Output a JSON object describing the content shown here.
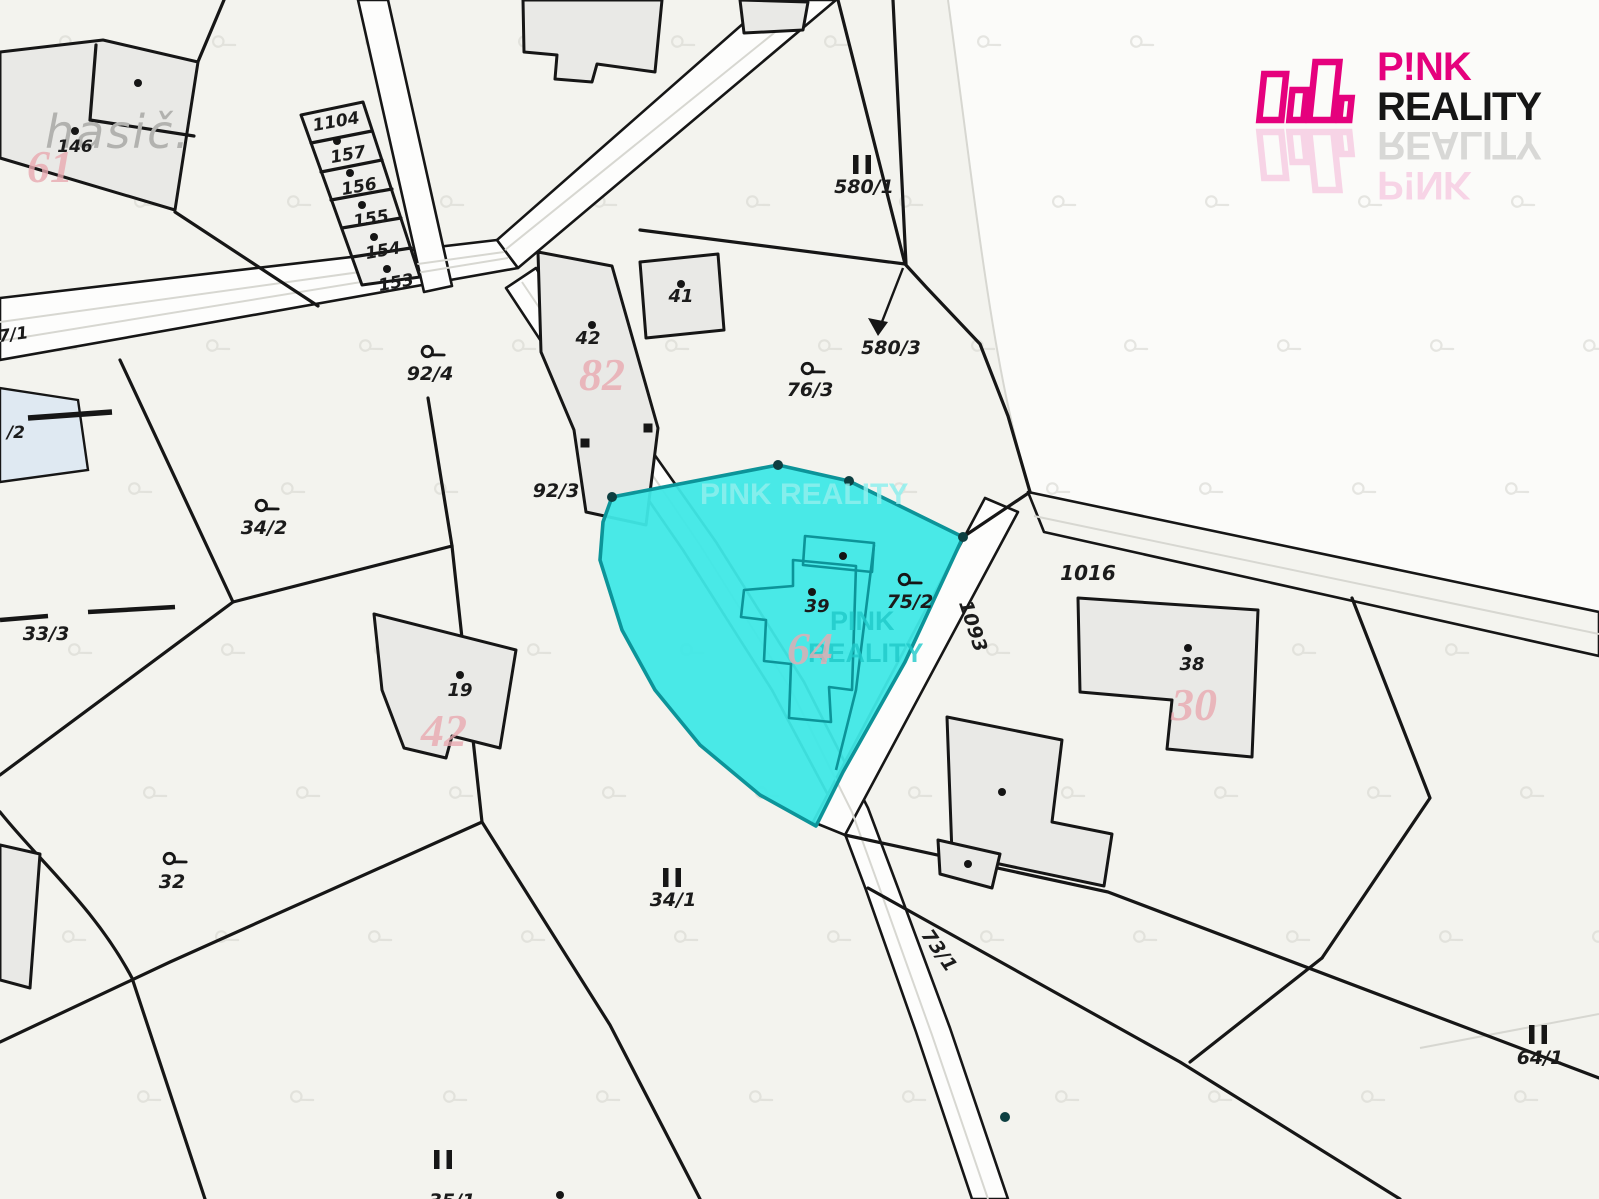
{
  "branding": {
    "pink": "P!NK",
    "reality": "REALITY",
    "magenta_color": "#e5017d",
    "text_color": "#161616"
  },
  "map": {
    "colors": {
      "background": "#f3f3ee",
      "white_region": "#fbfbf9",
      "road_fill": "#fdfdfc",
      "building_fill": "#e9e9e6",
      "boundary_line": "#161616",
      "highlight_fill": "#3fe8e6",
      "highlight_stroke": "#0c9499",
      "pink_house_number": "#e9aab1",
      "gray_area_label": "#b2b2af",
      "faint_line": "#d7d7d1",
      "water": "#dfe9f2",
      "watermark_light": "#8ff0ee",
      "watermark_dark": "#1fc9c9"
    },
    "area_label": {
      "text": "hasič.",
      "x": 118,
      "y": 148
    },
    "parcel_labels": [
      {
        "text": "146",
        "x": 75,
        "y": 152,
        "s": 17
      },
      {
        "text": "1104",
        "x": 337,
        "y": 127,
        "s": 17,
        "r": -10
      },
      {
        "text": "157",
        "x": 349,
        "y": 160,
        "s": 17,
        "r": -10
      },
      {
        "text": "156",
        "x": 360,
        "y": 192,
        "s": 17,
        "r": -10
      },
      {
        "text": "155",
        "x": 372,
        "y": 224,
        "s": 17,
        "r": -10
      },
      {
        "text": "154",
        "x": 384,
        "y": 256,
        "s": 17,
        "r": -10
      },
      {
        "text": "153",
        "x": 397,
        "y": 288,
        "s": 17,
        "r": -10
      },
      {
        "text": "7/1",
        "x": 14,
        "y": 340,
        "s": 17,
        "r": -8
      },
      {
        "text": "/2",
        "x": 16,
        "y": 438,
        "s": 17
      },
      {
        "text": "41",
        "x": 681,
        "y": 302,
        "s": 18
      },
      {
        "text": "42",
        "x": 588,
        "y": 344,
        "s": 18
      },
      {
        "text": "92/4",
        "x": 430,
        "y": 380,
        "s": 19
      },
      {
        "text": "580/1",
        "x": 864,
        "y": 193,
        "s": 19
      },
      {
        "text": "580/3",
        "x": 891,
        "y": 354,
        "s": 19
      },
      {
        "text": "76/3",
        "x": 810,
        "y": 396,
        "s": 19
      },
      {
        "text": "92/3",
        "x": 556,
        "y": 497,
        "s": 19
      },
      {
        "text": "34/2",
        "x": 264,
        "y": 534,
        "s": 19
      },
      {
        "text": "33/3",
        "x": 46,
        "y": 640,
        "s": 19
      },
      {
        "text": "1016",
        "x": 1088,
        "y": 580,
        "s": 20
      },
      {
        "text": "1093",
        "x": 967,
        "y": 628,
        "s": 19,
        "r": 72
      },
      {
        "text": "75/2",
        "x": 910,
        "y": 608,
        "s": 19
      },
      {
        "text": "39",
        "x": 817,
        "y": 612,
        "s": 18
      },
      {
        "text": "38",
        "x": 1192,
        "y": 670,
        "s": 18
      },
      {
        "text": "19",
        "x": 460,
        "y": 696,
        "s": 18
      },
      {
        "text": "32",
        "x": 172,
        "y": 888,
        "s": 19
      },
      {
        "text": "34/1",
        "x": 673,
        "y": 906,
        "s": 19
      },
      {
        "text": "73/1",
        "x": 934,
        "y": 954,
        "s": 19,
        "r": 55
      },
      {
        "text": "64/1",
        "x": 1540,
        "y": 1064,
        "s": 19
      },
      {
        "text": "35/1",
        "x": 452,
        "y": 1207,
        "s": 19
      }
    ],
    "house_numbers": [
      {
        "text": "61",
        "x": 50,
        "y": 182
      },
      {
        "text": "82",
        "x": 602,
        "y": 390
      },
      {
        "text": "42",
        "x": 444,
        "y": 746
      },
      {
        "text": "64",
        "x": 810,
        "y": 664
      },
      {
        "text": "30",
        "x": 1194,
        "y": 720
      }
    ],
    "watermarks": [
      {
        "text": "PINK REALITY",
        "x": 700,
        "y": 504,
        "s": 30,
        "tone": "light"
      },
      {
        "text": "PINK",
        "x": 830,
        "y": 630,
        "s": 27,
        "tone": "dark"
      },
      {
        "text": "REALITY",
        "x": 808,
        "y": 662,
        "s": 27,
        "tone": "dark"
      }
    ],
    "landuse_symbols": [
      {
        "x": 428,
        "y": 352
      },
      {
        "x": 808,
        "y": 369
      },
      {
        "x": 262,
        "y": 506
      },
      {
        "x": 905,
        "y": 580
      },
      {
        "x": 170,
        "y": 859
      }
    ],
    "ii_symbols": [
      {
        "x": 862,
        "y": 165
      },
      {
        "x": 672,
        "y": 878
      },
      {
        "x": 443,
        "y": 1160
      },
      {
        "x": 1538,
        "y": 1035
      }
    ],
    "building_dots": [
      {
        "x": 75,
        "y": 131
      },
      {
        "x": 138,
        "y": 83
      },
      {
        "x": 337,
        "y": 141
      },
      {
        "x": 350,
        "y": 173
      },
      {
        "x": 362,
        "y": 205
      },
      {
        "x": 374,
        "y": 237
      },
      {
        "x": 387,
        "y": 269
      },
      {
        "x": 681,
        "y": 284
      },
      {
        "x": 592,
        "y": 325
      },
      {
        "x": 812,
        "y": 592
      },
      {
        "x": 843,
        "y": 556
      },
      {
        "x": 1188,
        "y": 648
      },
      {
        "x": 460,
        "y": 675
      },
      {
        "x": 1002,
        "y": 792
      },
      {
        "x": 968,
        "y": 864
      },
      {
        "x": 560,
        "y": 1195
      }
    ],
    "vertex_dots": [
      {
        "x": 612,
        "y": 497
      },
      {
        "x": 778,
        "y": 465
      },
      {
        "x": 849,
        "y": 481
      },
      {
        "x": 963,
        "y": 537
      },
      {
        "x": 1005,
        "y": 1117
      }
    ],
    "vertex_squares": [
      {
        "x": 585,
        "y": 443
      },
      {
        "x": 648,
        "y": 428
      }
    ]
  }
}
